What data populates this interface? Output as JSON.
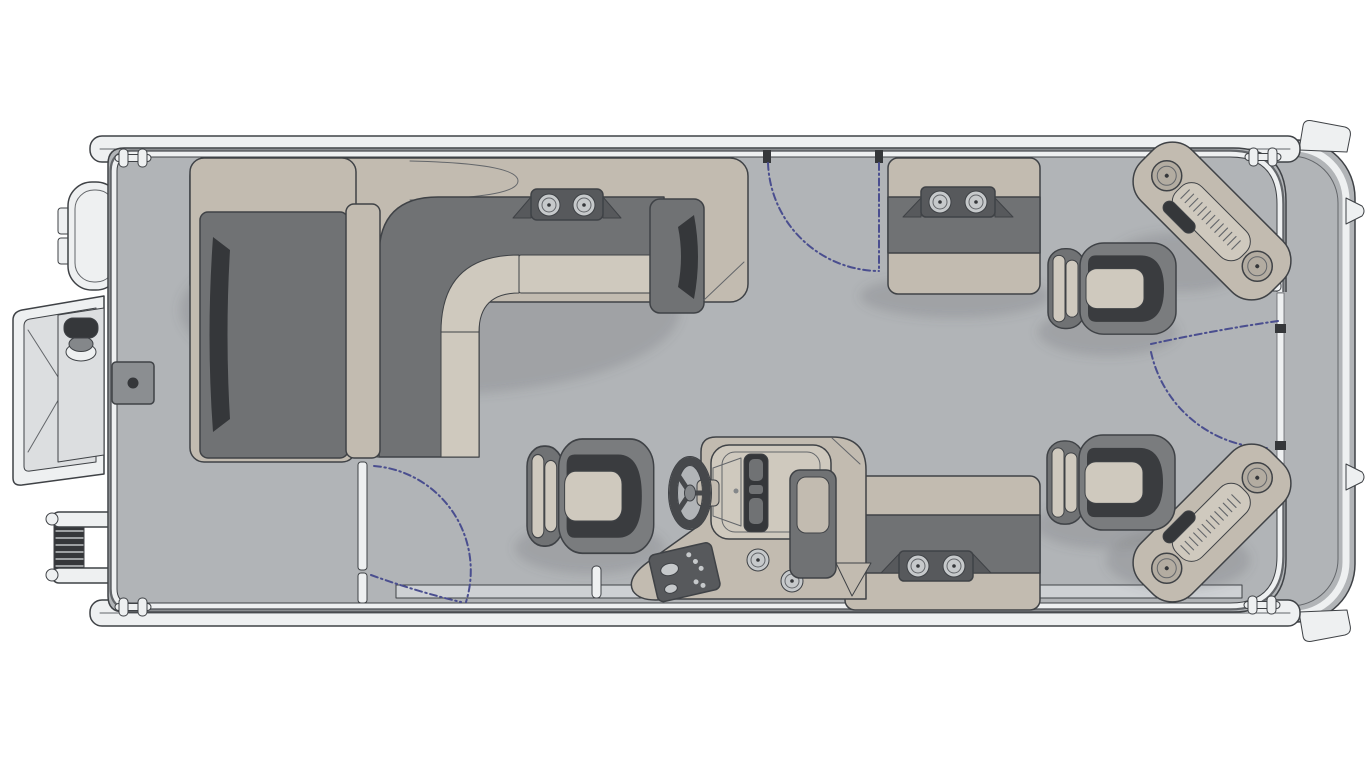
{
  "diagram": {
    "label": "Pontoon boat floor plan, overhead view",
    "type": "boat-floorplan",
    "orientation": "stern-left-bow-right"
  },
  "palette": {
    "background": "#ffffff",
    "deck": "#b1b4b7",
    "deck_light": "#ced1d4",
    "hull_white": "#eef0f1",
    "platform_gray": "#dcdee0",
    "upholstery_tan": "#c2bbb0",
    "upholstery_tan_light": "#cfc9be",
    "upholstery_gray": "#707274",
    "panel_dark": "#57595c",
    "seat_shell": "#7a7c7e",
    "seat_dark": "#3a3c3f",
    "ink_dark": "#35373a",
    "metal_mid": "#84878a",
    "cup_gray": "#c6c9cb",
    "speaker_tan": "#b3aca1",
    "hatch_gray": "#8b8e91",
    "wheel_dark": "#46484b",
    "outline": "#3f4246",
    "outline_soft": "#63666a",
    "swing_blue": "#4a4e8f"
  },
  "features": {
    "seating": [
      "l-shaped-lounge-port",
      "chaise-lounge-port",
      "captain-chair",
      "bow-bench-starboard",
      "aft-bench-starboard",
      "fishing-seat-bow",
      "fishing-seat-aft"
    ],
    "helm": [
      "steering-wheel",
      "windscreen",
      "instrument-cluster",
      "gauge-panel",
      "console-cup-holders"
    ],
    "access": [
      "bow-gate",
      "starboard-gate",
      "port-gate",
      "swim-platform",
      "boarding-ladder",
      "outboard-motor"
    ],
    "bow_corner_pads": [
      "corner-step-starboard-bow",
      "corner-step-port-bow"
    ],
    "counts": {
      "cup_holders": 8,
      "speakers": 4,
      "bucket_seats": 3,
      "benches": 2,
      "cleats": 4,
      "gate_swing_arcs": 3,
      "deck_hatches": 1
    }
  }
}
